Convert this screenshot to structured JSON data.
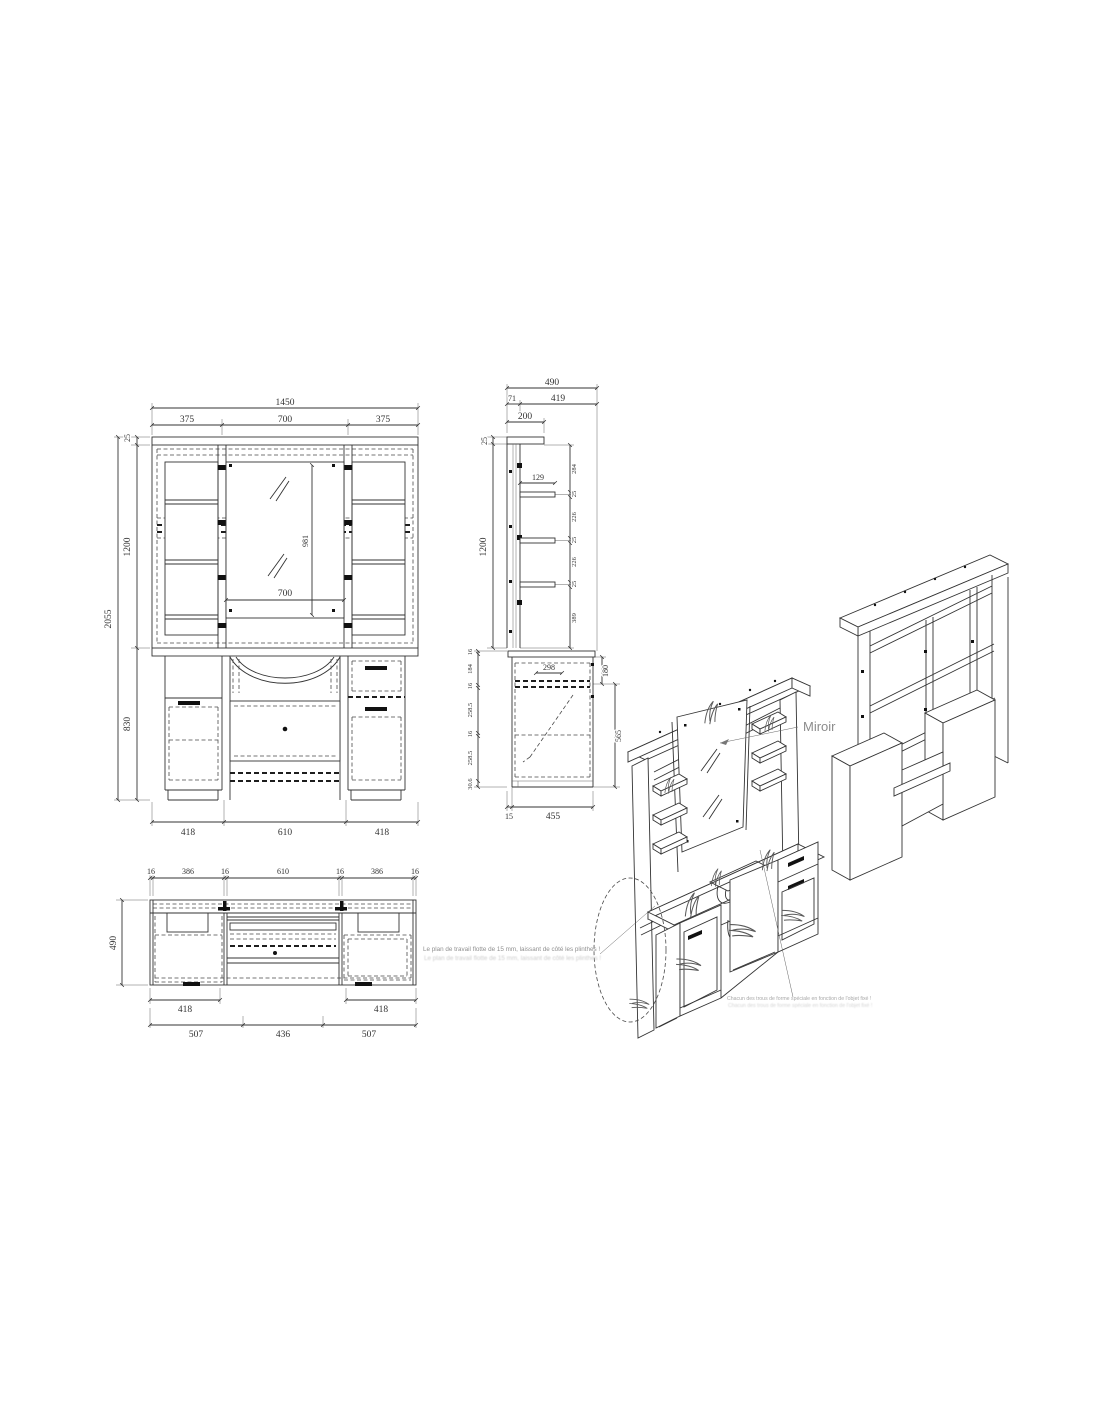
{
  "drawing_type": "furniture technical drawing - vanity dressing table with mirror",
  "front": {
    "w_total": "1450",
    "w_left": "375",
    "w_mid": "700",
    "w_right": "375",
    "t_top": "25",
    "h_upper": "1200",
    "h_total": "2055",
    "h_lower": "830",
    "mirror_h": "981",
    "mirror_w": "700",
    "b_left": "418",
    "b_mid": "610",
    "b_right": "418"
  },
  "side": {
    "d_total": "490",
    "d_back": "71",
    "d_front": "419",
    "d_shelf": "200",
    "t_top": "25",
    "h_upper": "1200",
    "shelf_len": "129",
    "r1": "284",
    "r2": "25",
    "r3": "226",
    "r4": "25",
    "r5": "226",
    "r6": "25",
    "r7": "389",
    "l1": "16",
    "l2": "184",
    "l3": "16",
    "l4": "258.5",
    "l5": "16",
    "l6": "258.5",
    "l7": "30.6",
    "inner": "298",
    "rr1": "180",
    "rr2": "565",
    "b1": "15",
    "b2": "455"
  },
  "plan": {
    "t1": "16",
    "t2": "386",
    "t3": "16",
    "t4": "610",
    "t5": "16",
    "t6": "386",
    "t7": "16",
    "depth": "490",
    "p_left": "418",
    "p_right": "418",
    "b1": "507",
    "b2": "436",
    "b3": "507"
  },
  "iso": {
    "miroir": "Miroir",
    "note1": "Le plan de travail flotte de 15 mm, laissant de côté les plinthes !",
    "note1_ghost": "Le plan de travail flotte de 15 mm, laissant de côté les plinthes !",
    "note2": "Chacun des trous de forme spéciale en fonction de l'objet fixé !",
    "note2_ghost": "Chacun des trous de forme spéciale en fonction de l'objet fixé !"
  },
  "colors": {
    "line": "#333333",
    "dim_text": "#333333",
    "note_gray": "#8f8f8f",
    "label_gray": "#8c8c8c"
  }
}
